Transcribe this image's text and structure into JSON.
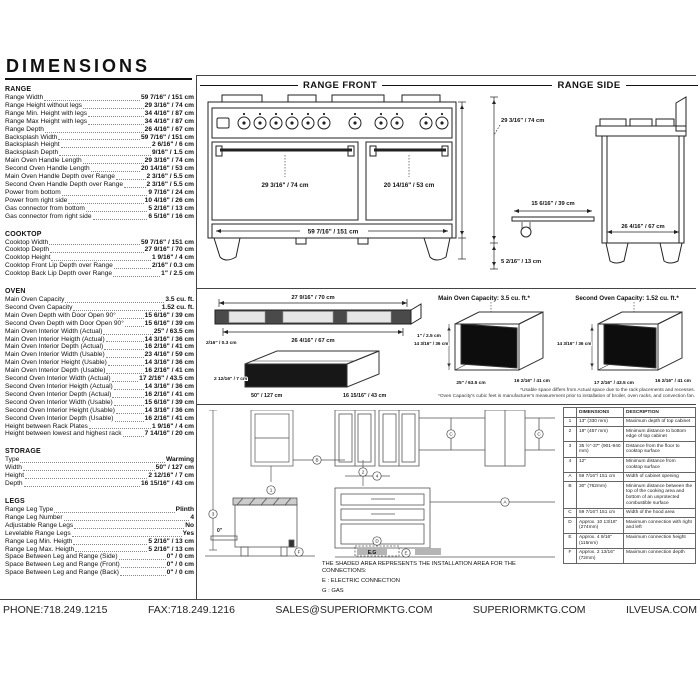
{
  "header": {
    "title": "DIMENSIONS"
  },
  "specs": {
    "range": {
      "title": "RANGE",
      "rows": [
        {
          "label": "Range Width",
          "value": "59 7/16\" / 151 cm"
        },
        {
          "label": "Range Height without legs",
          "value": "29 3/16\" / 74 cm"
        },
        {
          "label": "Range Min. Height with legs",
          "value": "34 4/16\" / 87 cm"
        },
        {
          "label": "Range Max Height with legs",
          "value": "34 4/16\" / 87 cm"
        },
        {
          "label": "Range Depth",
          "value": "26 4/16\" / 67 cm"
        },
        {
          "label": "Backsplash Width",
          "value": "59 7/16\" / 151 cm"
        },
        {
          "label": "Backsplash Height",
          "value": "2 6/16\" / 6 cm"
        },
        {
          "label": "Backsplash Depth",
          "value": "9/16\" / 1.5 cm"
        },
        {
          "label": "Main Oven Handle Length",
          "value": "29 3/16\" / 74 cm"
        },
        {
          "label": "Second Oven Handle Length",
          "value": "20 14/16\" / 53 cm"
        },
        {
          "label": "Main Oven Handle Depth over Range",
          "value": "2 3/16\" / 5.5 cm"
        },
        {
          "label": "Second Oven Handle Depth over Range",
          "value": "2 3/16\" / 5.5 cm"
        },
        {
          "label": "Power from bottom",
          "value": "9 7/16\" / 24 cm"
        },
        {
          "label": "Power from right side",
          "value": "10 4/16\" / 26 cm"
        },
        {
          "label": "Gas connector from bottom",
          "value": "5 2/16\" / 13 cm"
        },
        {
          "label": "Gas connector from right side",
          "value": "6 5/16\" / 16 cm"
        }
      ]
    },
    "cooktop": {
      "title": "COOKTOP",
      "rows": [
        {
          "label": "Cooktop Width",
          "value": "59 7/16\" / 151 cm"
        },
        {
          "label": "Cooktop Depth",
          "value": "27 9/16\" / 70 cm"
        },
        {
          "label": "Cooktop Height",
          "value": "1 9/16\" / 4 cm"
        },
        {
          "label": "Cooktop Front Lip Depth over Range",
          "value": "2/16\" / 0.3 cm"
        },
        {
          "label": "Cooktop Back Lip Depth over Range",
          "value": "1\" / 2.5 cm"
        }
      ]
    },
    "oven": {
      "title": "OVEN",
      "rows": [
        {
          "label": "Main Oven Capacity",
          "value": "3.5 cu. ft."
        },
        {
          "label": "Second Oven Capacity",
          "value": "1.52 cu. ft."
        },
        {
          "label": "Main Oven Depth with Door Open 90°",
          "value": "15 6/16\" / 39 cm"
        },
        {
          "label": "Second Oven Depth with Door Open 90°",
          "value": "15 6/16\" / 39 cm"
        },
        {
          "label": "Main Oven Interior Width (Actual)",
          "value": "25\" / 63.5 cm"
        },
        {
          "label": "Main Oven Interior Heigth (Actual)",
          "value": "14 3/16\" / 36 cm"
        },
        {
          "label": "Main Oven Interior Depth (Actual)",
          "value": "16 2/16\" / 41 cm"
        },
        {
          "label": "Main Oven Interior Width (Usable)",
          "value": "23 4/16\" / 59 cm"
        },
        {
          "label": "Main Oven Interior Height (Usable)",
          "value": "14 3/16\" / 36 cm"
        },
        {
          "label": "Main Oven Interior Depth (Usable)",
          "value": "16 2/16\" / 41 cm"
        },
        {
          "label": "Second Oven Interior Width (Actual)",
          "value": "17 2/16\" / 43.5 cm"
        },
        {
          "label": "Second Oven Interior Heigth (Actual)",
          "value": "14 3/16\" / 36 cm"
        },
        {
          "label": "Second Oven Interior Depth (Actual)",
          "value": "16 2/16\" / 41 cm"
        },
        {
          "label": "Second Oven Interior Width (Usable)",
          "value": "15 6/16\" / 39 cm"
        },
        {
          "label": "Second Oven Interior Height (Usable)",
          "value": "14 3/16\" / 36 cm"
        },
        {
          "label": "Second Oven Interior Depth (Usable)",
          "value": "16 2/16\" / 41 cm"
        },
        {
          "label": "Height between Rack Plates",
          "value": "1 9/16\" / 4 cm"
        },
        {
          "label": "Height between lowest and highest rack",
          "value": "7 14/16\" / 20 cm"
        }
      ]
    },
    "storage": {
      "title": "STORAGE",
      "rows": [
        {
          "label": "Type",
          "value": "Warming"
        },
        {
          "label": "Width",
          "value": "50\" / 127 cm"
        },
        {
          "label": "Height",
          "value": "2 12/16\" / 7 cm"
        },
        {
          "label": "Depth",
          "value": "16 15/16\" / 43 cm"
        }
      ]
    },
    "legs": {
      "title": "LEGS",
      "rows": [
        {
          "label": "Range Leg Type",
          "value": "Plinth"
        },
        {
          "label": "Range Leg Number",
          "value": "4"
        },
        {
          "label": "Adjustable Range Legs",
          "value": "No"
        },
        {
          "label": "Levelable Range Legs",
          "value": "Yes"
        },
        {
          "label": "Range Leg Min. Heigth",
          "value": "5 2/16\" / 13 cm"
        },
        {
          "label": "Range Leg Max. Heigth",
          "value": "5 2/16\" / 13 cm"
        },
        {
          "label": "Space Between Leg and Range (Side)",
          "value": "0\" / 0 cm"
        },
        {
          "label": "Space Between Leg and Range (Front)",
          "value": "0\" / 0 cm"
        },
        {
          "label": "Space Between Leg and Range (Back)",
          "value": "0\" / 0 cm"
        }
      ]
    }
  },
  "front": {
    "title": "RANGE FRONT",
    "main_handle": "29 3/16\" / 74 cm",
    "second_handle": "20 14/16\" / 53 cm",
    "width": "59 7/16\" / 151 cm"
  },
  "side": {
    "title": "RANGE SIDE",
    "height": "29 3/16\" / 74 cm",
    "door_open": "15 6/16\" / 39 cm",
    "leg_height": "5 2/16\" / 13 cm",
    "depth": "26 4/16\" / 67 cm"
  },
  "cooktop_drawing": {
    "top_width": "27 9/16\" / 70 cm",
    "inner_width": "26 4/16\" / 67 cm",
    "back_lip": "1\" / 2.5 cm",
    "front_lip": "2/16\" / 0.3 cm"
  },
  "storage_drawing": {
    "height": "2 12/16\" / 7 cm",
    "width": "50\" / 127 cm",
    "depth": "16 15/16\" / 43 cm"
  },
  "main_oven_drawing": {
    "title": "Main Oven Capacity: 3.5 cu. ft.*",
    "height": "14 3/16\" / 36 cm",
    "width": "25\" / 63.5 cm",
    "depth": "16 2/16\" / 41 cm"
  },
  "second_oven_drawing": {
    "title": "Second Oven Capacity: 1.52 cu. ft.*",
    "height": "14 3/16\" / 36 cm",
    "width": "17 2/16\" / 43.5 cm",
    "depth": "16 2/16\" / 41 cm"
  },
  "footnotes": [
    "*Usable space differs from Actual space due to the rack placements and recesses.",
    "*Oven Capacity's cubic feet is manufacturer's measurement prior to installation of broiler, oven racks, and convection fan."
  ],
  "diagram": {
    "caption": "THE SHADED AREA REPRESENTS THE INSTALLATION AREA FOR THE CONNECTIONS:",
    "legend_e": "E : ELECTRIC CONNECTION",
    "legend_g": "G : GAS",
    "markers": {
      "m1": "1",
      "m2": "2",
      "m3": "3",
      "m4": "4",
      "mA": "A",
      "mB": "B",
      "mC": "C",
      "mD": "D",
      "mE": "E",
      "mF": "F",
      "eg": "E.G",
      "zero": "0\""
    }
  },
  "table": {
    "headers": [
      "",
      "DIMENSIONS",
      "DESCRIPTION"
    ],
    "rows": [
      {
        "id": "1",
        "dim": "13\" (330 mm)",
        "desc": "Maximum depth of top cabinet"
      },
      {
        "id": "2",
        "dim": "18\" (457 mm)",
        "desc": "Minimum distance to bottom edge of top cabinet"
      },
      {
        "id": "3",
        "dim": "35 ½\"-37\" (901-940 mm)",
        "desc": "Distance from the floor to cooktop surface"
      },
      {
        "id": "4",
        "dim": "12\"",
        "desc": "Minimum distance from cooktop surface"
      },
      {
        "id": "A",
        "dim": "59 7/16\"/ 151 cm",
        "desc": "Width of cabinet opening"
      },
      {
        "id": "B",
        "dim": "30\" (762mm)",
        "desc": "Minimum distance between the top of the cooking area and bottom of an unprotected combustible surface"
      },
      {
        "id": "C",
        "dim": "59 7/16\"/ 151 cm",
        "desc": "Width of the hood area"
      },
      {
        "id": "D",
        "dim": "Approx. 10 13/16\" (274mm)",
        "desc": "Maximum connection with right and left"
      },
      {
        "id": "E",
        "dim": "Approx. 4 9/16\" (115mm)",
        "desc": "Maximum connection height"
      },
      {
        "id": "F",
        "dim": "Approx. 2 13/16\" (72mm)",
        "desc": "Maximum connection depth"
      }
    ]
  },
  "footer": {
    "items": [
      "PHONE:718.249.1215",
      "FAX:718.249.1216",
      "SALES@SUPERIORMKTG.COM",
      "SUPERIORMKTG.COM",
      "ILVEUSA.COM"
    ]
  }
}
